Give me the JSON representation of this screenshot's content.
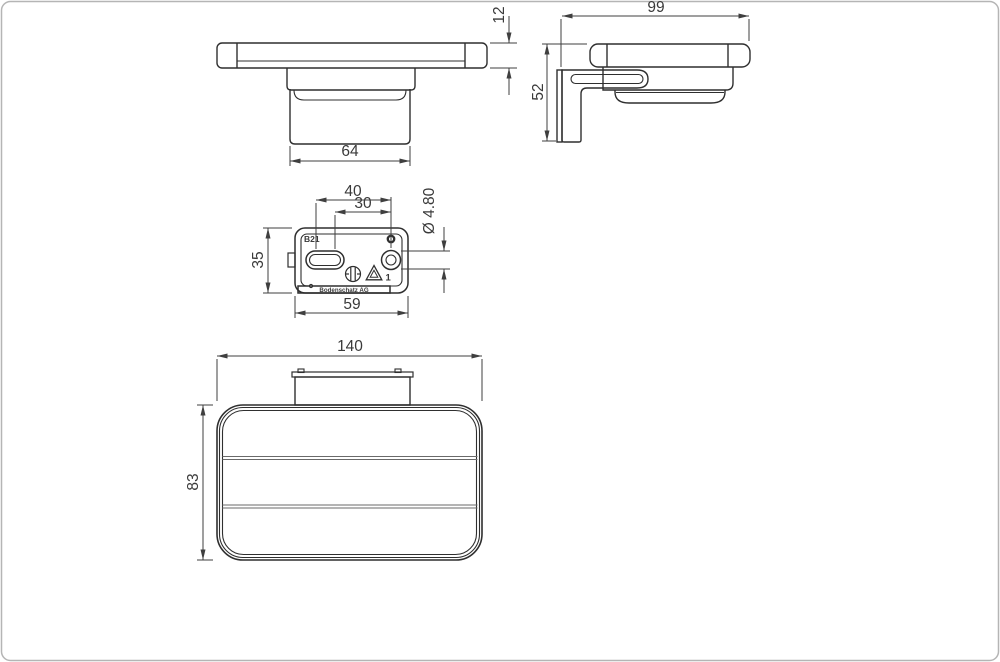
{
  "drawing": {
    "title": "Soap holder technical drawing",
    "views": {
      "front": {
        "dim_cup_width": "64",
        "dim_rail_thickness": "12"
      },
      "side": {
        "dim_depth": "99",
        "dim_height": "52"
      },
      "plate": {
        "dim_hole_spacing_outer": "40",
        "dim_hole_spacing_inner": "30",
        "dim_hole_diameter": "Ø 4.80",
        "dim_plate_height": "35",
        "dim_plate_width": "59",
        "label_code": "B21",
        "label_brand": "Bodenschatz AG",
        "label_material_class": "1"
      },
      "top": {
        "dim_overall_width": "140",
        "dim_overall_depth": "83"
      }
    },
    "colors": {
      "object_line": "#2f2f2f",
      "dimension_line": "#3f3f3f",
      "divider_line": "#6a6a6a",
      "frame": "#b5b5b5",
      "background": "#ffffff"
    }
  }
}
